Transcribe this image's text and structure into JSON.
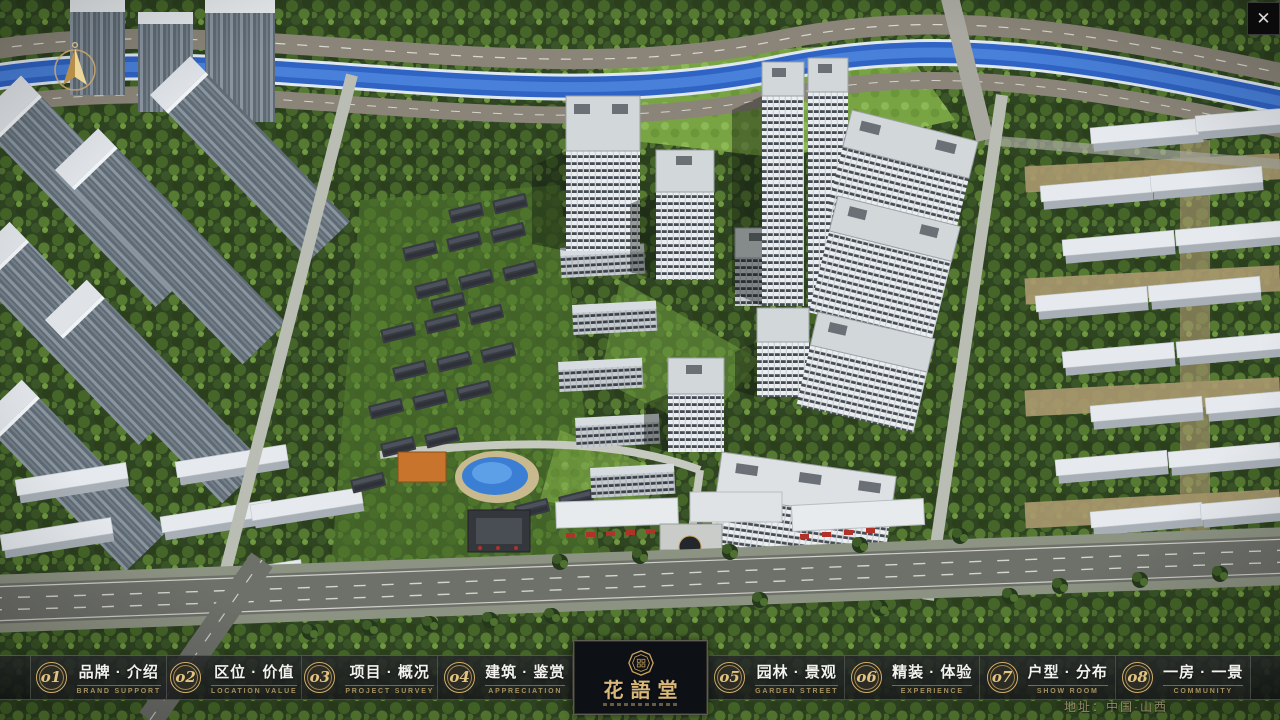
{
  "app": {
    "close_glyph": "✕"
  },
  "navbar": {
    "items": [
      {
        "num": "o1",
        "cn": "品牌 · 介绍",
        "en": "BRAND SUPPORT"
      },
      {
        "num": "o2",
        "cn": "区位 · 价值",
        "en": "LOCATION VALUE"
      },
      {
        "num": "o3",
        "cn": "项目 · 概况",
        "en": "PROJECT SURVEY"
      },
      {
        "num": "o4",
        "cn": "建筑 · 鉴赏",
        "en": "APPRECIATION"
      },
      {
        "num": "o5",
        "cn": "园林 · 景观",
        "en": "GARDEN STREET"
      },
      {
        "num": "o6",
        "cn": "精装 · 体验",
        "en": "EXPERIENCE"
      },
      {
        "num": "o7",
        "cn": "户型 · 分布",
        "en": "SHOW ROOM"
      },
      {
        "num": "o8",
        "cn": "一房 · 一景",
        "en": "COMMUNITY"
      }
    ],
    "logo": {
      "cn": "花語堂"
    }
  },
  "footer": {
    "address": "地址：中国·山西"
  },
  "colors": {
    "gold": "#c9a469",
    "nav_en_text": "#a8925e",
    "bar_bg": "rgba(20,22,23,0.84)",
    "river_blue": "#2f63c4",
    "logo_bg": "#0d1116"
  }
}
